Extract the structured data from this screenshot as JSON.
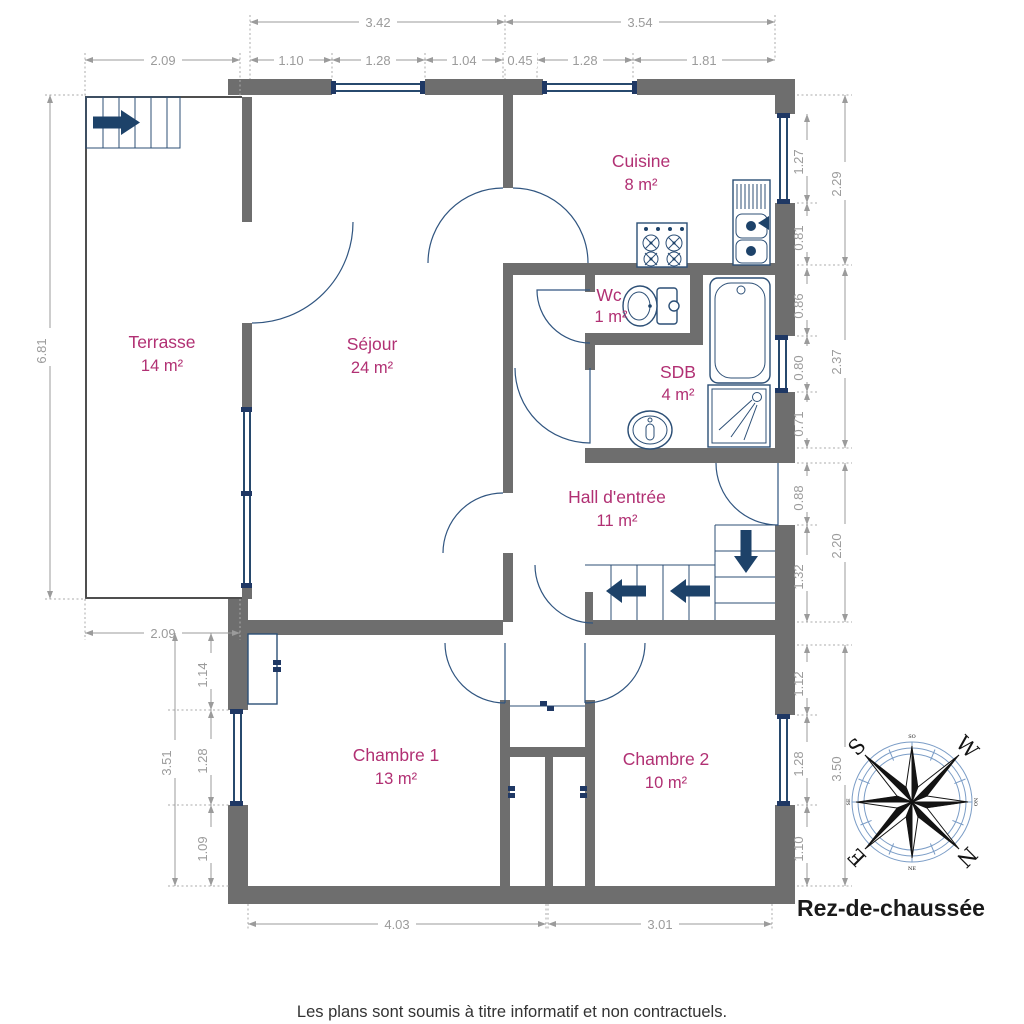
{
  "title": "Rez-de-chaussée",
  "disclaimer": "Les plans sont soumis à titre informatif et non contractuels.",
  "rooms": {
    "terrasse": {
      "name": "Terrasse",
      "area": "14 m²"
    },
    "sejour": {
      "name": "Séjour",
      "area": "24 m²"
    },
    "cuisine": {
      "name": "Cuisine",
      "area": "8 m²"
    },
    "wc": {
      "name": "Wc",
      "area": "1 m²"
    },
    "sdb": {
      "name": "SDB",
      "area": "4 m²"
    },
    "hall": {
      "name": "Hall d'entrée",
      "area": "11 m²"
    },
    "chambre1": {
      "name": "Chambre 1",
      "area": "13 m²"
    },
    "chambre2": {
      "name": "Chambre 2",
      "area": "10 m²"
    }
  },
  "dims": {
    "top1": [
      "3.42",
      "3.54"
    ],
    "top2": [
      "2.09",
      "1.10",
      "1.28",
      "1.04",
      "0.45",
      "1.28",
      "1.81"
    ],
    "bottom": [
      "4.03",
      "3.01"
    ],
    "bottom_left": "2.09",
    "left": [
      "6.81",
      "3.51",
      "1.14",
      "1.28",
      "1.09"
    ],
    "right_in": [
      "1.27",
      "0.81",
      "0.86",
      "0.80",
      "0.71",
      "0.88",
      "1.32",
      "1.12",
      "1.28",
      "1.10"
    ],
    "right_out": [
      "2.29",
      "2.37",
      "2.20",
      "3.50"
    ]
  },
  "compass": {
    "n": "N",
    "s": "S",
    "e": "E",
    "w": "W",
    "minor": [
      "SO",
      "NO",
      "NE",
      "SE"
    ]
  },
  "colors": {
    "wall": "#6e6e6e",
    "room_label": "#b13073",
    "dimension": "#9b9b9b",
    "fixture": "#2c4f76",
    "arrow": "#1d4269",
    "compass": "#131313"
  }
}
